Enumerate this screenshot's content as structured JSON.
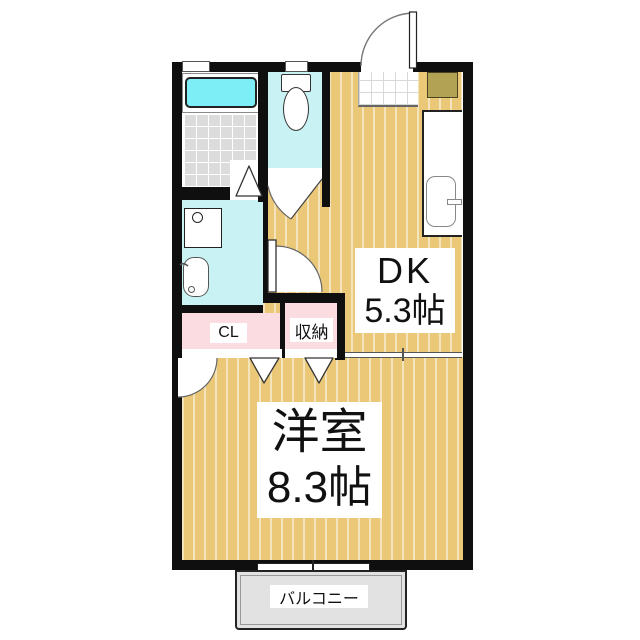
{
  "rooms": {
    "dk": {
      "label": "DK",
      "area": "5.3帖"
    },
    "western": {
      "label": "洋室",
      "area": "8.3帖"
    },
    "closet": {
      "label": "CL"
    },
    "storage": {
      "label": "収納"
    },
    "balcony": {
      "label": "バルコニー"
    }
  },
  "fixtures": [
    "bathtub",
    "bathroom-tile-floor",
    "bathroom-door-triangle",
    "toilet",
    "toilet-door",
    "washbasin",
    "washing-machine-pan",
    "washroom-door",
    "kitchen-counter",
    "kitchen-sink",
    "kitchen-faucet",
    "shoe-cabinet",
    "entrance-tile",
    "entrance-door",
    "closet-folding-door",
    "storage-folding-door",
    "room-door",
    "bath-window",
    "toilet-window",
    "balcony-sliding-window"
  ],
  "colors": {
    "wall": "#0f0f0f",
    "floor": "#eac878",
    "floor-stripe": "rgba(255,255,255,0.5)",
    "tile": "#dcdcdc",
    "wet-room": "#c9f2f5",
    "bathtub": "#7deef5",
    "closet-pink": "#fbdce0",
    "shoe-cabinet": "#b2a254",
    "balcony-floor": "#e2e2e2",
    "label-bg": "#ffffff",
    "text": "#111111"
  }
}
